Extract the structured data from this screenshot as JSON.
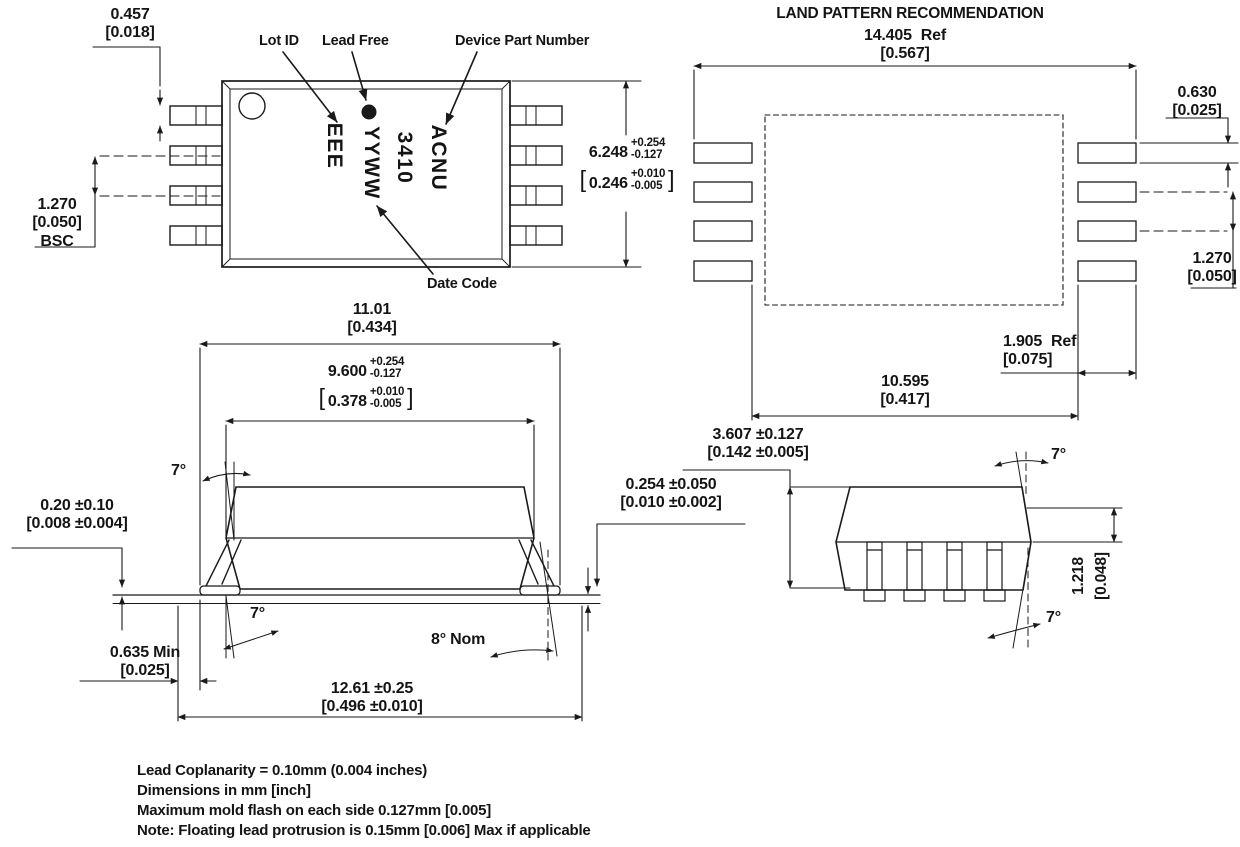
{
  "land_pattern_title": "LAND PATTERN RECOMMENDATION",
  "glyphs": {
    "open": "[",
    "close": "]"
  },
  "top_view": {
    "callouts": {
      "lot_id": "Lot ID",
      "lead_free": "Lead Free",
      "device_part_number": "Device Part Number",
      "date_code": "Date Code"
    },
    "marking": [
      "EEE",
      "YYWW",
      "3410",
      "ACNU"
    ],
    "dim_lead_width": {
      "mm": "0.457",
      "inch": "[0.018]"
    },
    "dim_pitch": {
      "mm": "1.270",
      "inch": "[0.050]",
      "note": "BSC"
    },
    "dim_body_width": {
      "mm": "6.248",
      "mm_plus": "+0.254",
      "mm_minus": "-0.127",
      "inch": "0.246",
      "inch_plus": "+0.010",
      "inch_minus": "-0.005"
    }
  },
  "land_pattern": {
    "dim_overall_width": {
      "mm": "14.405",
      "suffix": "Ref",
      "inch": "[0.567]"
    },
    "dim_pad_height": {
      "mm": "0.630",
      "inch": "[0.025]"
    },
    "dim_pad_pitch": {
      "mm": "1.270",
      "inch": "[0.050]"
    },
    "dim_pad_length": {
      "mm": "1.905",
      "suffix": "Ref",
      "inch": "[0.075]"
    },
    "dim_inner_span": {
      "mm": "10.595",
      "inch": "[0.417]"
    }
  },
  "side_view": {
    "dim_lead_span": {
      "mm": "11.01",
      "inch": "[0.434]"
    },
    "dim_body_length": {
      "mm": "9.600",
      "mm_plus": "+0.254",
      "mm_minus": "-0.127",
      "inch": "0.378",
      "inch_plus": "+0.010",
      "inch_minus": "-0.005"
    },
    "dim_standoff": {
      "mm": "0.20 ±0.10",
      "inch": "[0.008 ±0.004]"
    },
    "dim_lead_thickness": {
      "mm": "0.254 ±0.050",
      "inch": "[0.010 ±0.002]"
    },
    "dim_foot_length": {
      "mm": "0.635 Min",
      "inch": "[0.025]"
    },
    "dim_overall_length": {
      "mm": "12.61 ±0.25",
      "inch": "[0.496 ±0.010]"
    },
    "angle_lead_top": "7°",
    "angle_lead_bottom": "7°",
    "angle_foot": "8° Nom"
  },
  "end_view": {
    "dim_height": {
      "mm": "3.607 ±0.127",
      "inch": "[0.142 ±0.005]"
    },
    "dim_body_edge": {
      "mm": "1.218",
      "inch": "[0.048]"
    },
    "angle_top": "7°",
    "angle_bottom": "7°"
  },
  "notes": [
    "Lead Coplanarity = 0.10mm (0.004 inches)",
    "Dimensions in mm [inch]",
    "Maximum mold flash on each side 0.127mm [0.005]",
    "Note: Floating lead protrusion is 0.15mm [0.006] Max if applicable"
  ]
}
